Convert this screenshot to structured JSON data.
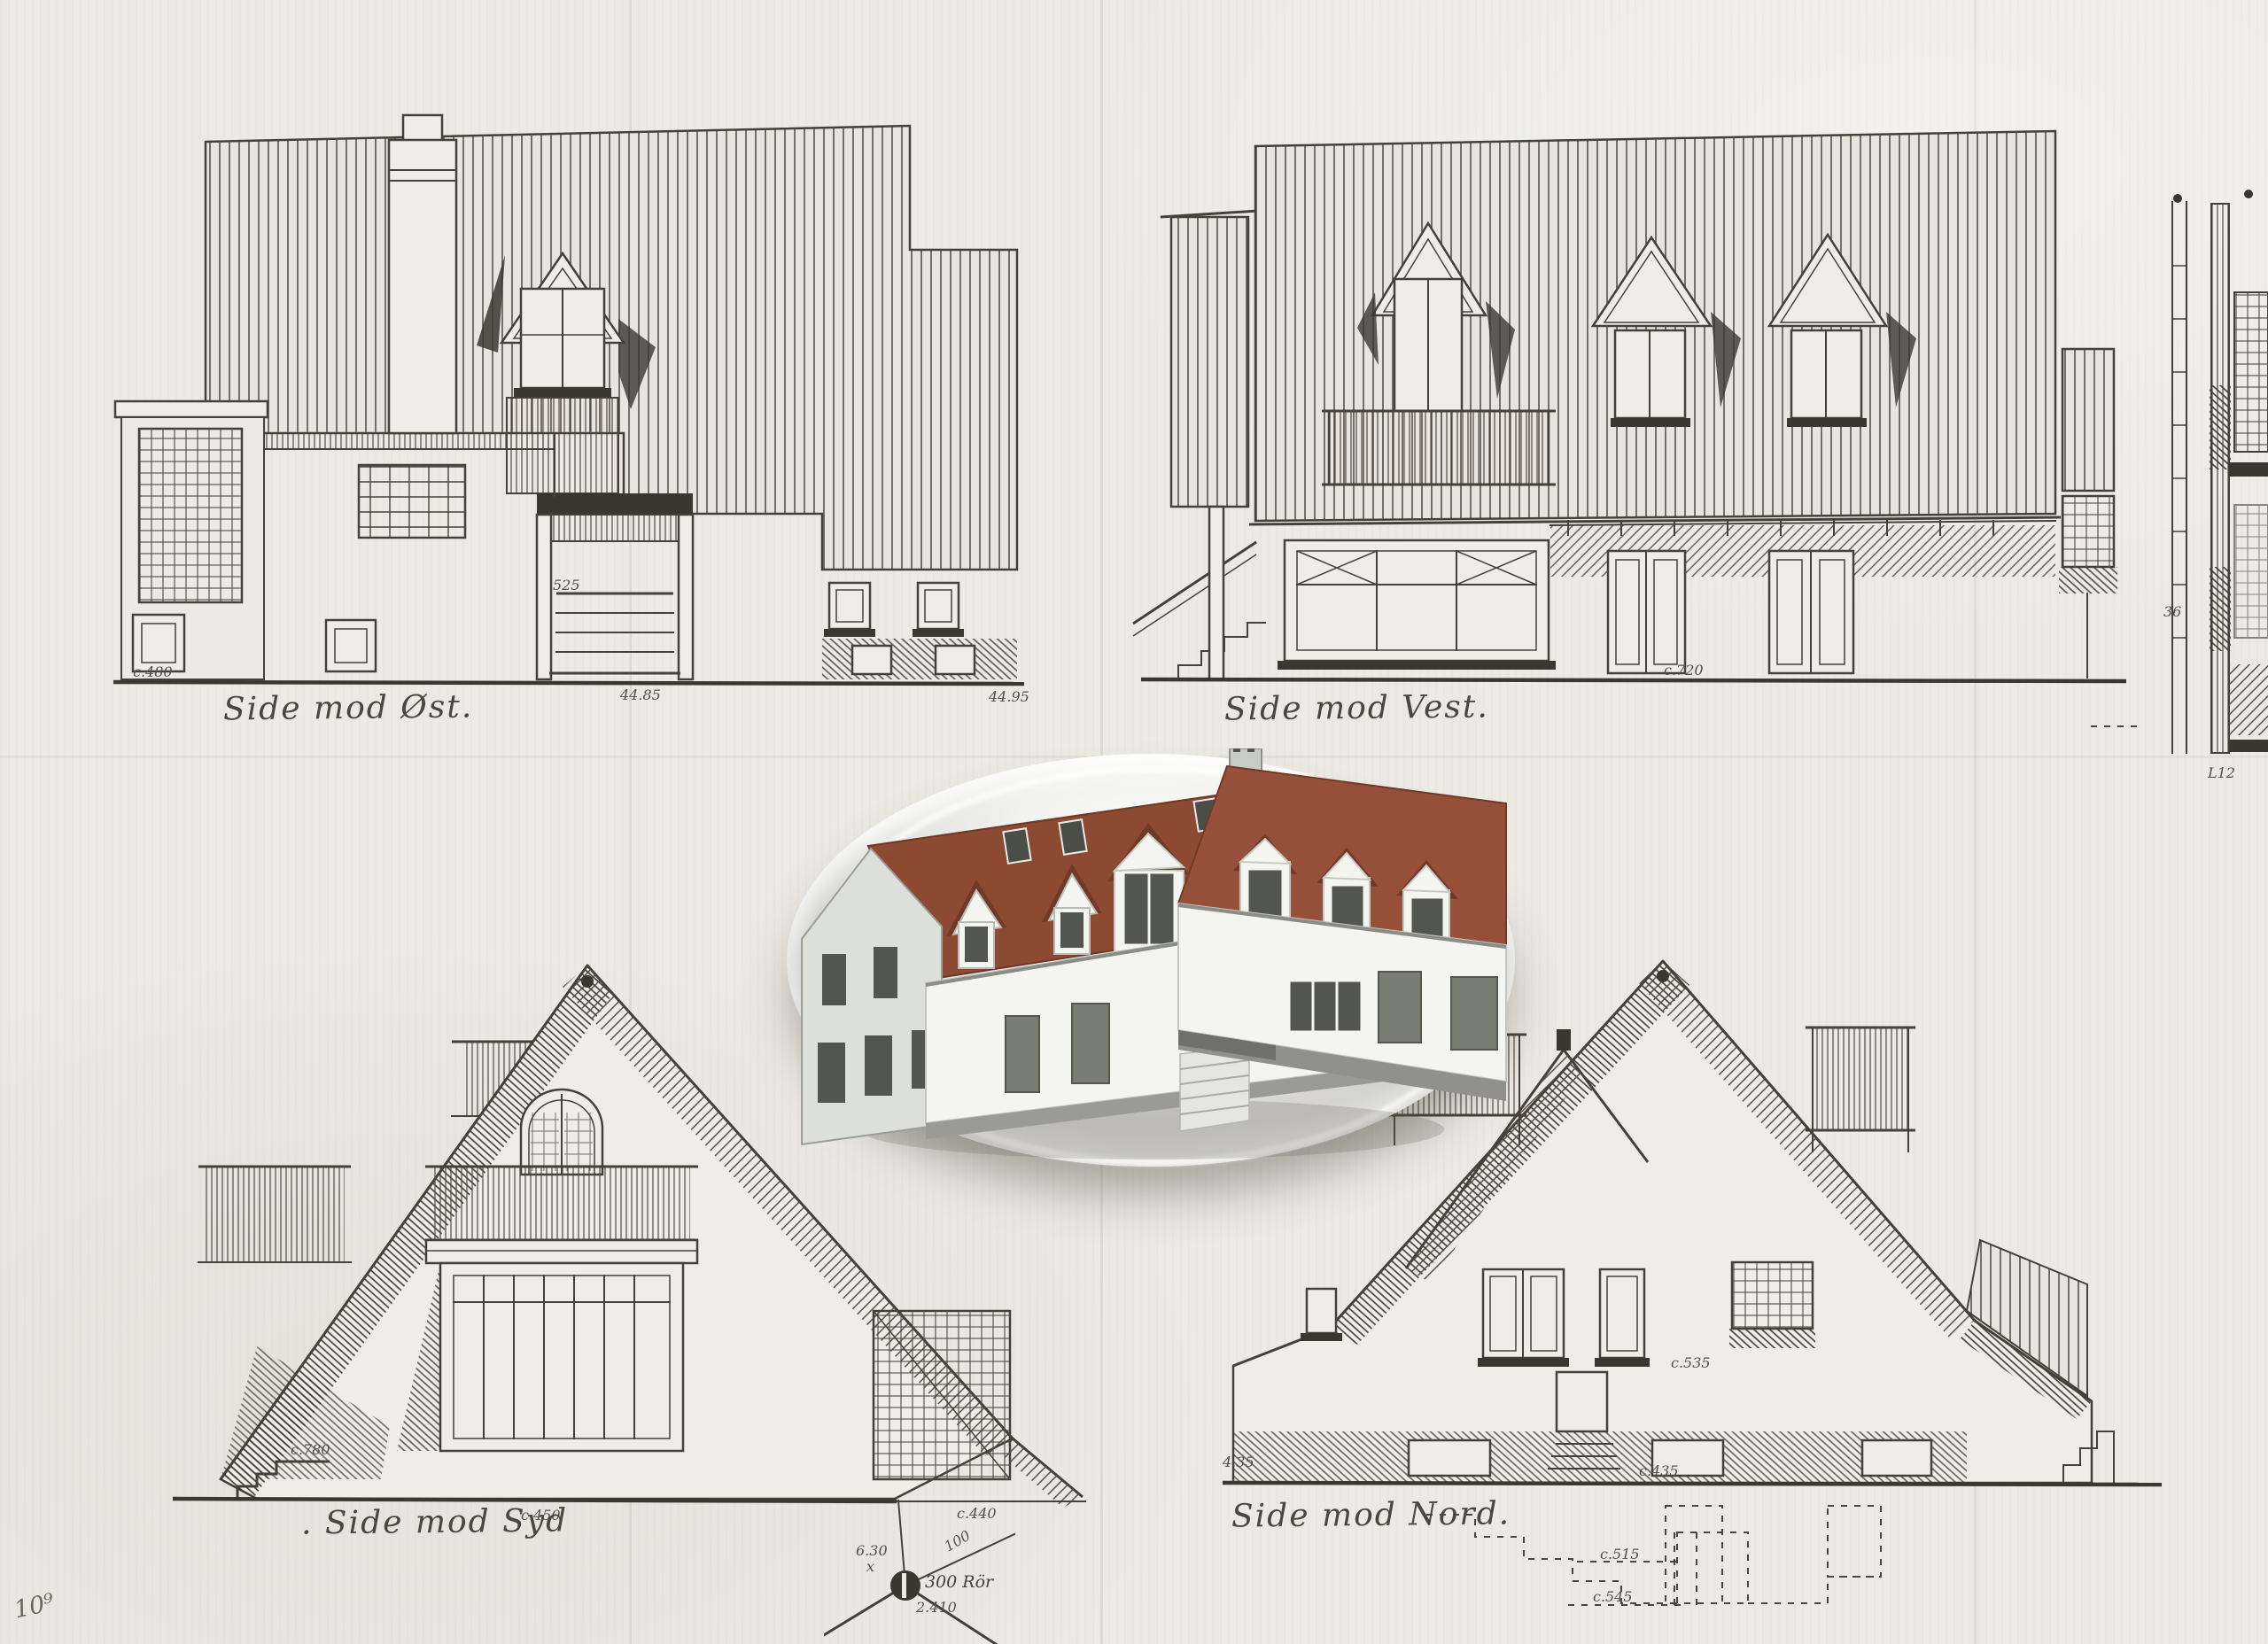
{
  "sheet": {
    "paper_color": "#ECEAE3",
    "ink_color": "#454138",
    "faint_ink_color": "#6B6659"
  },
  "labels": {
    "east": "Side mod Øst.",
    "west": "Side mod Vest.",
    "south": ". Side mod Syd",
    "north": "Side mod Nord."
  },
  "dims": {
    "east_left": "c.480",
    "east_step": "525",
    "east_base": "44.85",
    "east_right": "44.95",
    "west_base": "c.720",
    "south_left": "c.780",
    "south_base": "c.450",
    "south_right": "c.440",
    "north_left": "4.35",
    "north_mid": "c.535",
    "north_base": "c.435",
    "stair_upper": "c.515",
    "stair_lower": "c.545",
    "section_a": "36",
    "section_b": "L12"
  },
  "site": {
    "pipe": "300 Rör",
    "elev": "6.30",
    "dist": "2.410",
    "bearing": "100"
  },
  "corner_mark": "10⁹",
  "badge": {
    "roof_color": "#8C4A33",
    "roof_dark": "#713928",
    "wall_color": "#F4F4F0",
    "wall_shade": "#DDDFD9",
    "plinth_color": "#8F918A",
    "window_color": "#53564F"
  }
}
